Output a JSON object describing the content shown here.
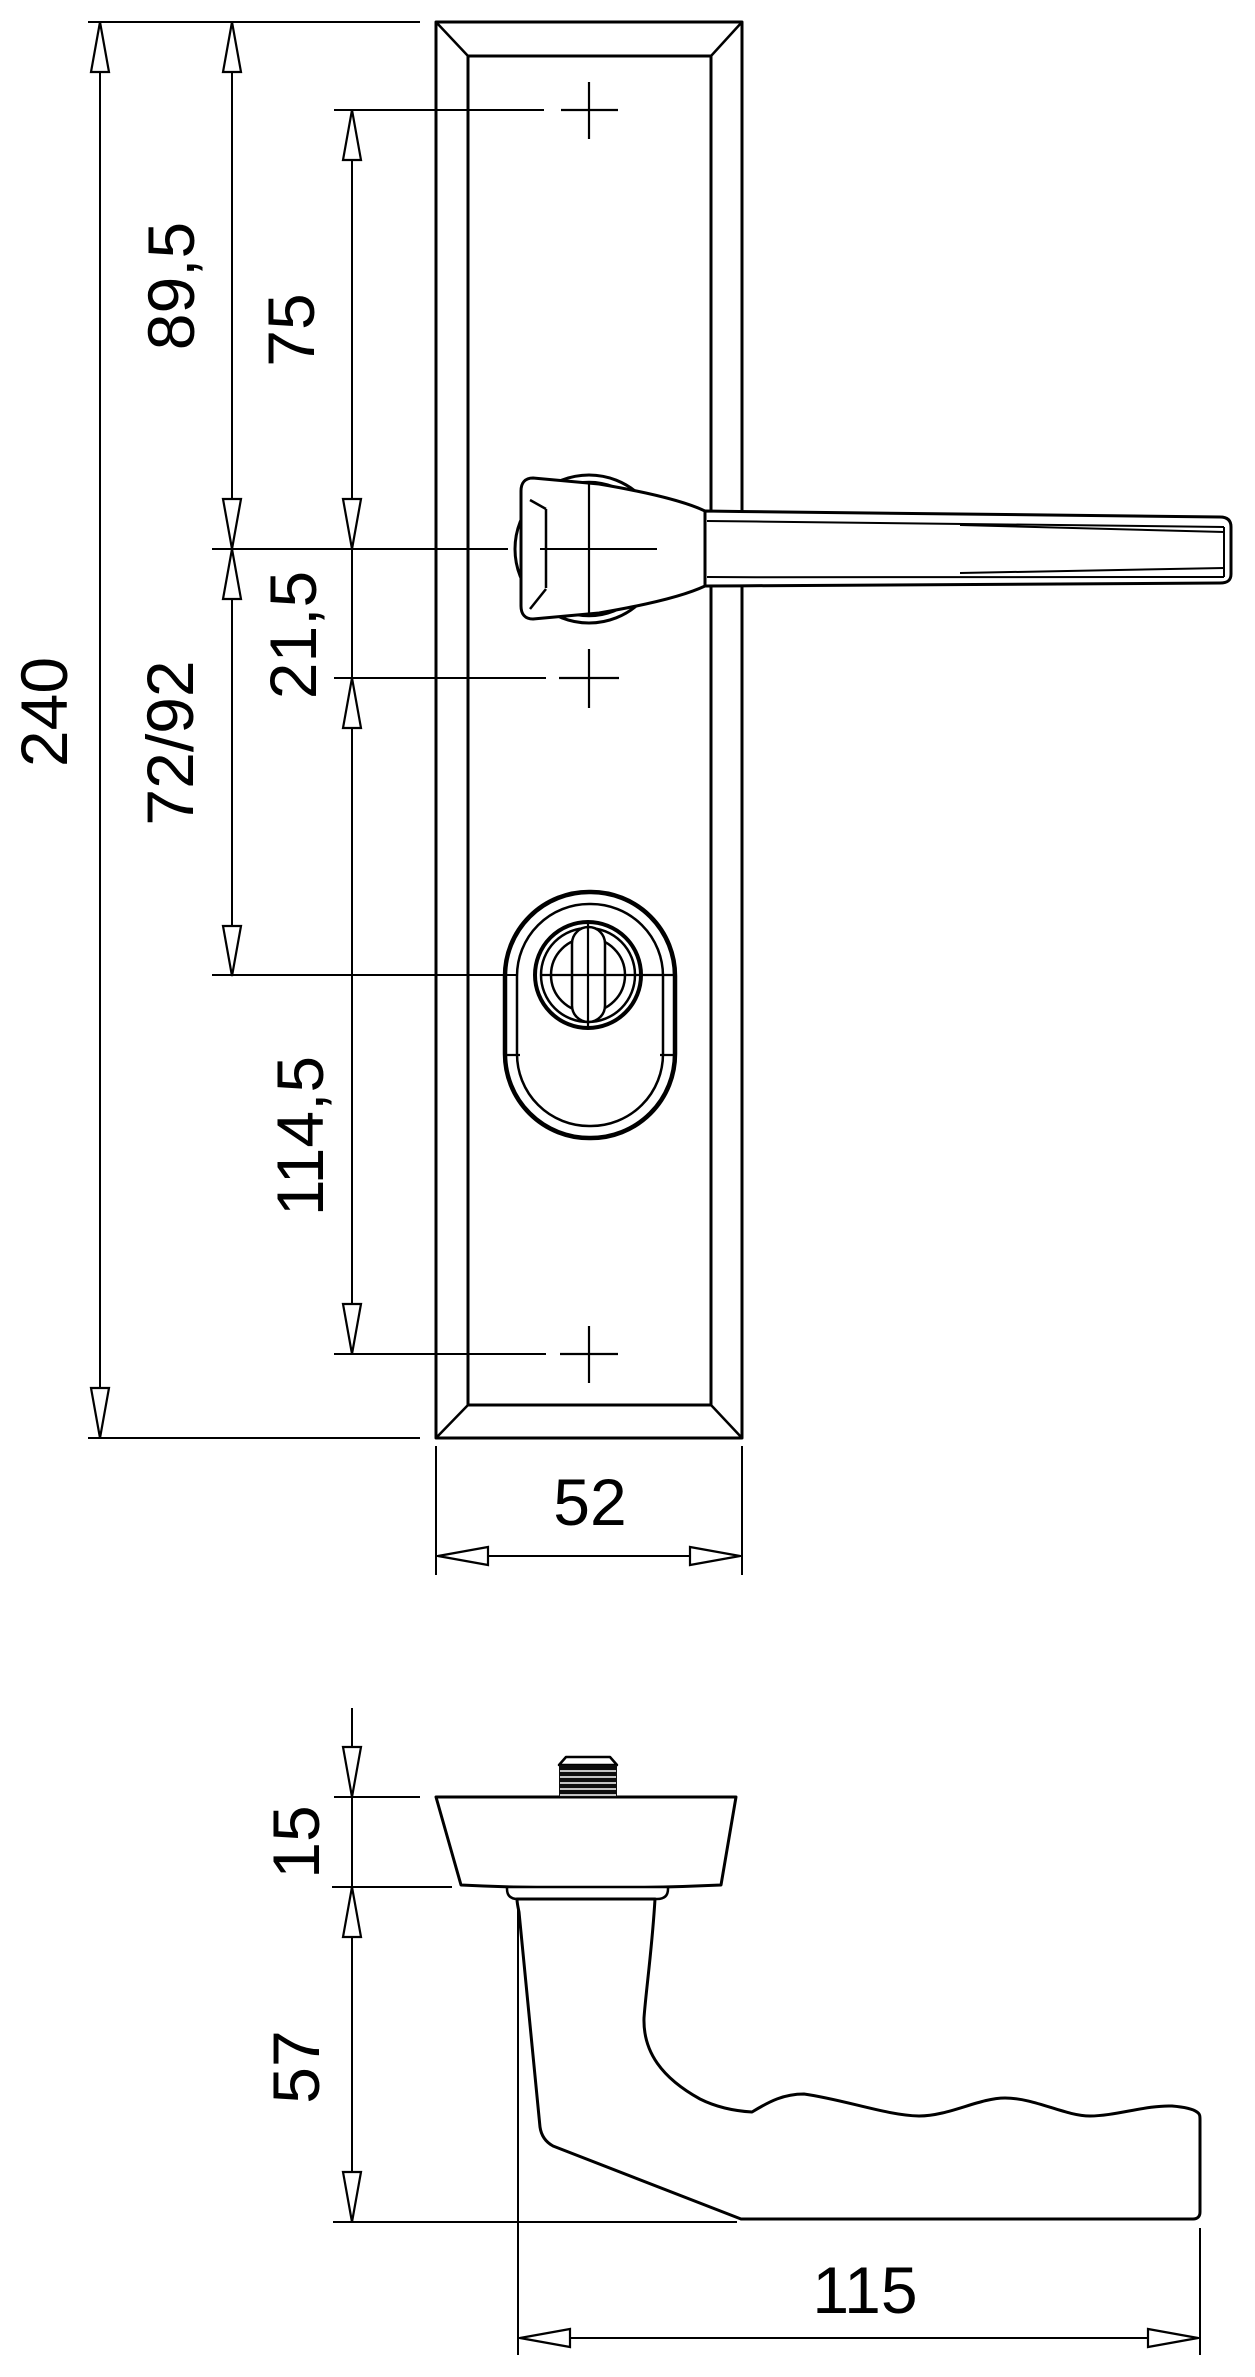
{
  "colors": {
    "background": "#ffffff",
    "line": "#000000"
  },
  "front_view": {
    "overall_height": "240",
    "plate_top_to_handle_axis": "89,5",
    "top_hole_to_handle_axis": "75",
    "handle_axis_to_cylinder": "21,5",
    "handle_axis_to_keyhole": "72/92",
    "cylinder_to_bottom_hole": "114,5",
    "plate_width": "52"
  },
  "side_view": {
    "flange_height": "15",
    "neck_projection": "57",
    "lever_length": "115"
  }
}
